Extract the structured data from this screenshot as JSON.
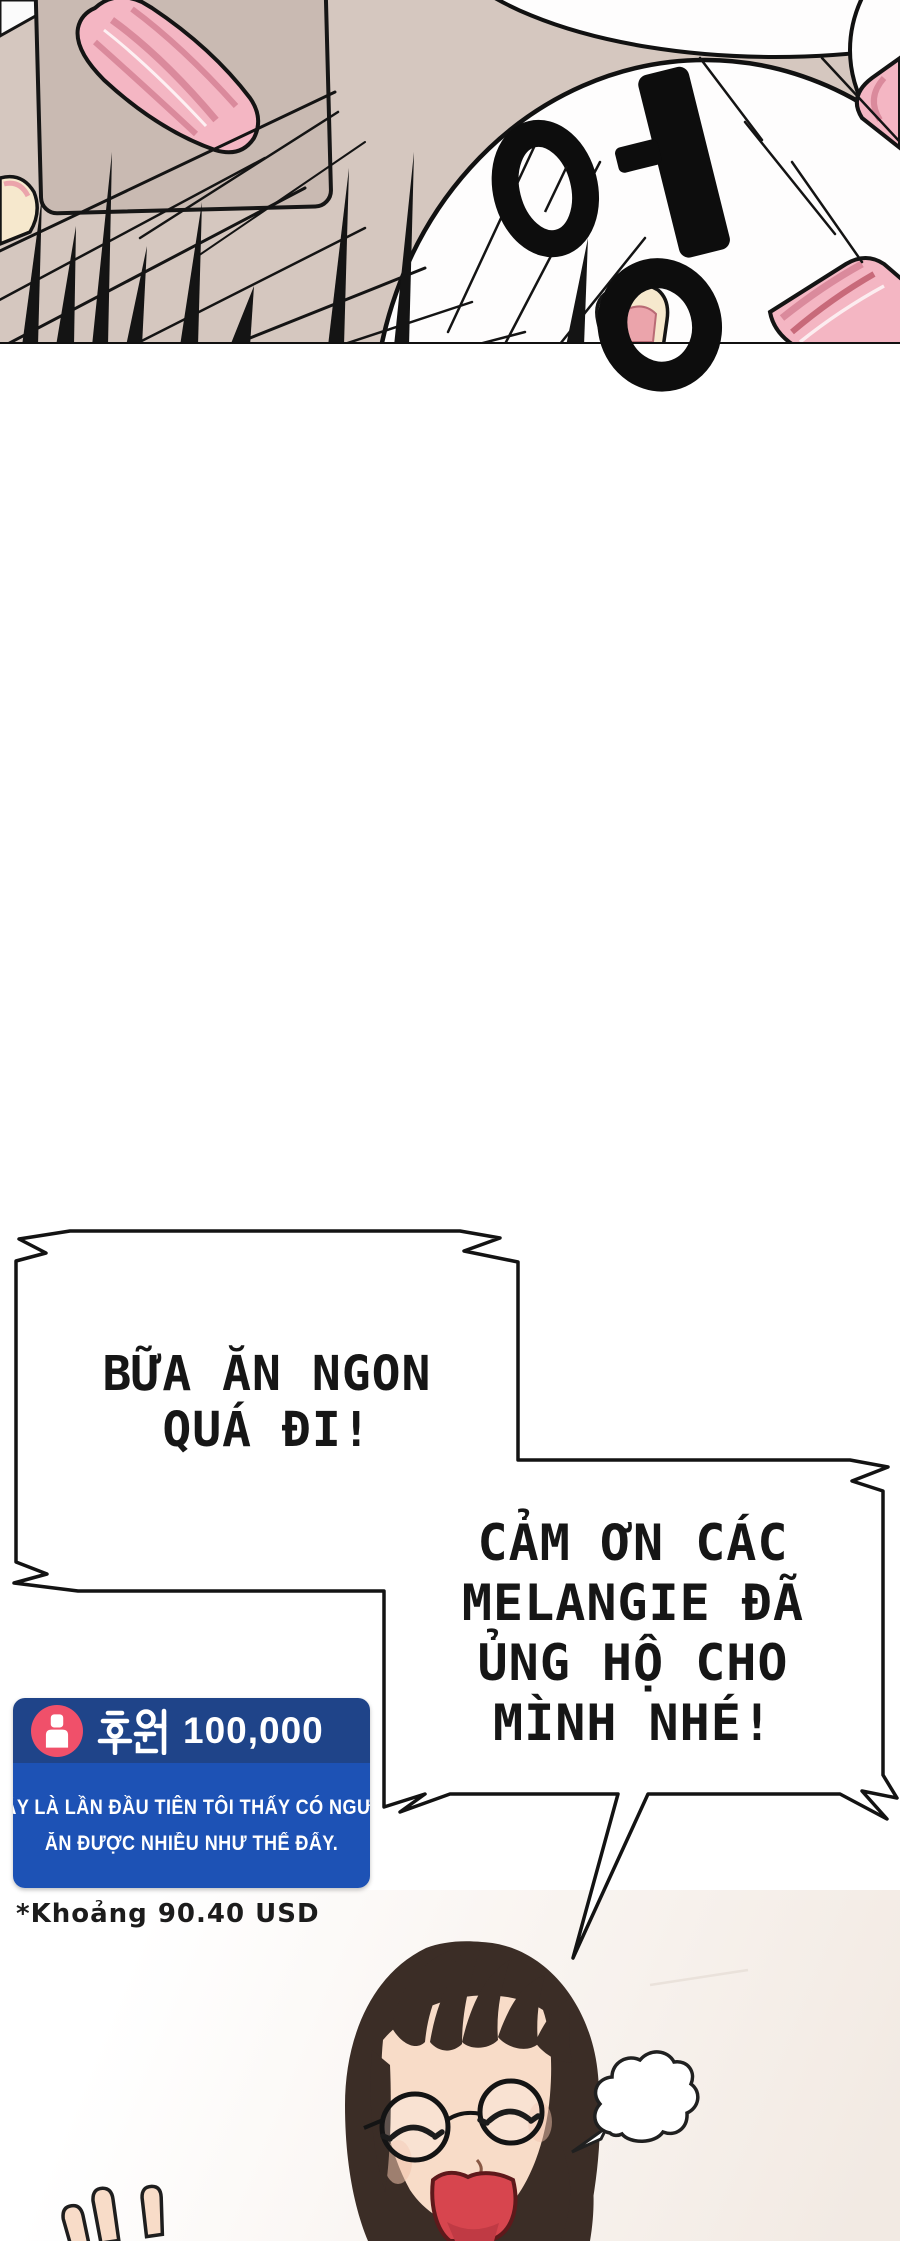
{
  "comic": {
    "sfx_korean": "엉",
    "bubble1": {
      "line1": "BỮA ĂN NGON",
      "line2": "QUÁ ĐI!"
    },
    "bubble2": {
      "line1": "CẢM ƠN CÁC",
      "line2": "MELANGIE ĐÃ",
      "line3": "ỦNG HỘ CHO",
      "line4": "MÌNH NHÉ!"
    },
    "donation": {
      "korean_label": "후원",
      "amount": "100,000",
      "message_line1": "ĐÂY LÀ LẦN ĐẦU TIÊN TÔI THẤY CÓ NGƯỜI",
      "message_line2": "ĂN ĐƯỢC NHIỀU NHƯ THẾ ĐẤY.",
      "footnote": "*Khoảng 90.40 USD"
    },
    "colors": {
      "panel_bg": "#d5c7bf",
      "slab": "#c9bab2",
      "plate": "#fefdfd",
      "meat": "#f4b6c3",
      "meat_stripe": "#da8a9c",
      "ink": "#141414",
      "donation_header": "#1f4489",
      "donation_body": "#1d52b5",
      "donation_icon": "#f0506a",
      "hair": "#3b2d26",
      "skin": "#f8dcc8",
      "mouth": "#d7454e"
    }
  }
}
